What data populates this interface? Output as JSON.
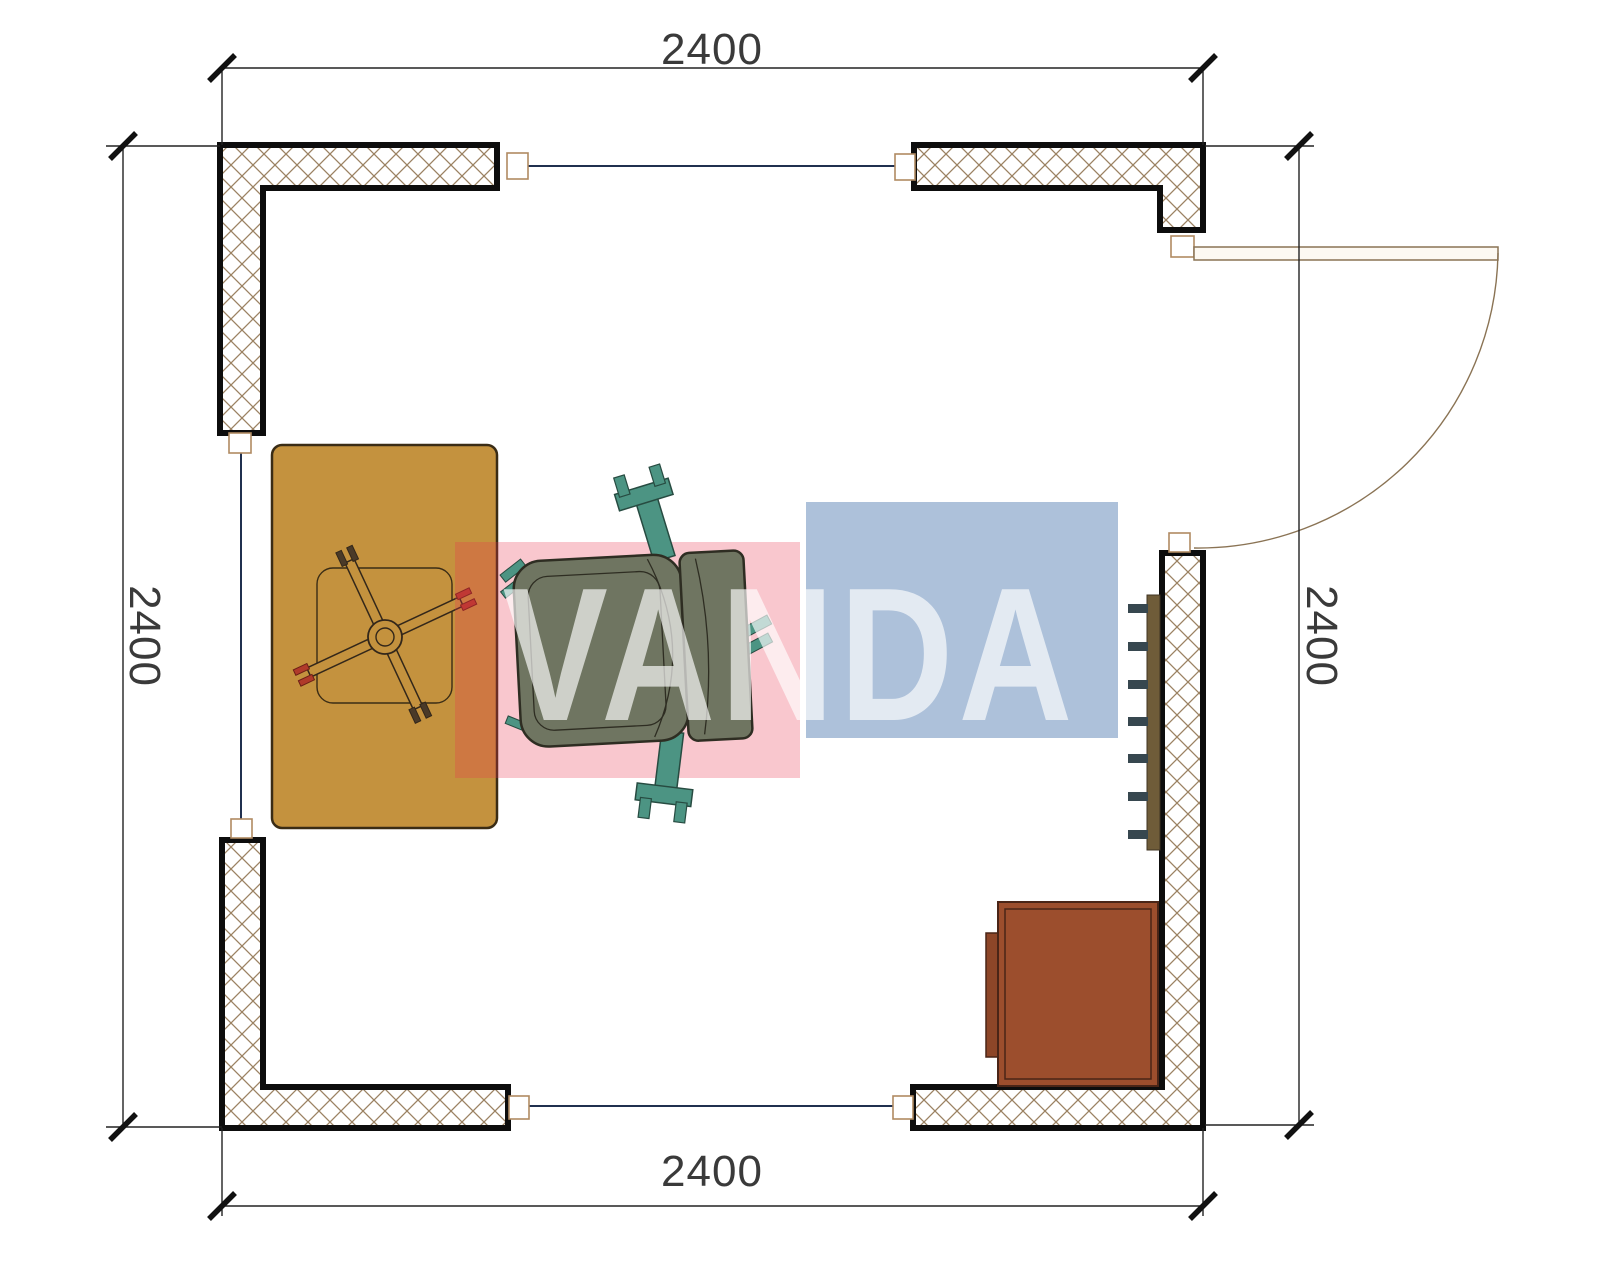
{
  "page": {
    "title": "Room floor plan",
    "background": "#ffffff"
  },
  "dimensions": {
    "top": {
      "label": "2400"
    },
    "bottom": {
      "label": "2400"
    },
    "left": {
      "label": "2400"
    },
    "right": {
      "label": "2400"
    }
  },
  "watermark": {
    "text": "VANDA",
    "red_block_color": "#e8354f",
    "blue_block_color": "#4a76ac",
    "text_color": "rgba(255,255,255,0.66)"
  },
  "objects": {
    "wall_hatch_color": "#9b8262",
    "wall_outline_color": "#0d0d0d",
    "window_line_color": "#20304f",
    "frame_outline_color": "#b08a62",
    "door_color": "#8a7354",
    "desk_color": "#c4923e",
    "desk_outline_color": "#3a2c15",
    "chair_seat_color": "#6f7561",
    "chair_armrest_color": "#4c9483",
    "caster_red_color": "#b03a2a",
    "cabinet_color": "#9c4e2d",
    "radiator_body_color": "#6f5c39",
    "radiator_fin_color": "#37474f"
  }
}
